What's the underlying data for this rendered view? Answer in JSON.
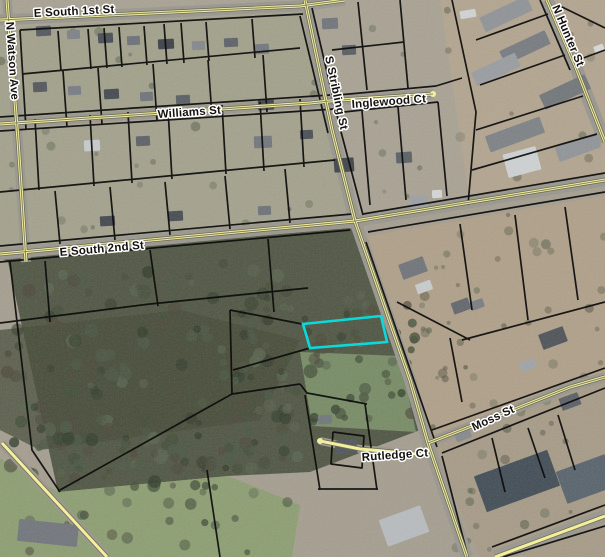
{
  "map": {
    "type": "aerial-parcel-map",
    "highlight": {
      "outline_color": "#0cd9d9",
      "description": "selected parcel"
    },
    "road_line_color": "#f4ef9e",
    "parcel_line_color": "#0c0c0c",
    "streets": [
      {
        "name": "E South 1st St"
      },
      {
        "name": "N Watson Ave"
      },
      {
        "name": "Williams St"
      },
      {
        "name": "Inglewood Ct"
      },
      {
        "name": "S Stribling St"
      },
      {
        "name": "N Hunter St"
      },
      {
        "name": "E South 2nd St"
      },
      {
        "name": "Moss St"
      },
      {
        "name": "Rutledge Ct"
      }
    ]
  }
}
